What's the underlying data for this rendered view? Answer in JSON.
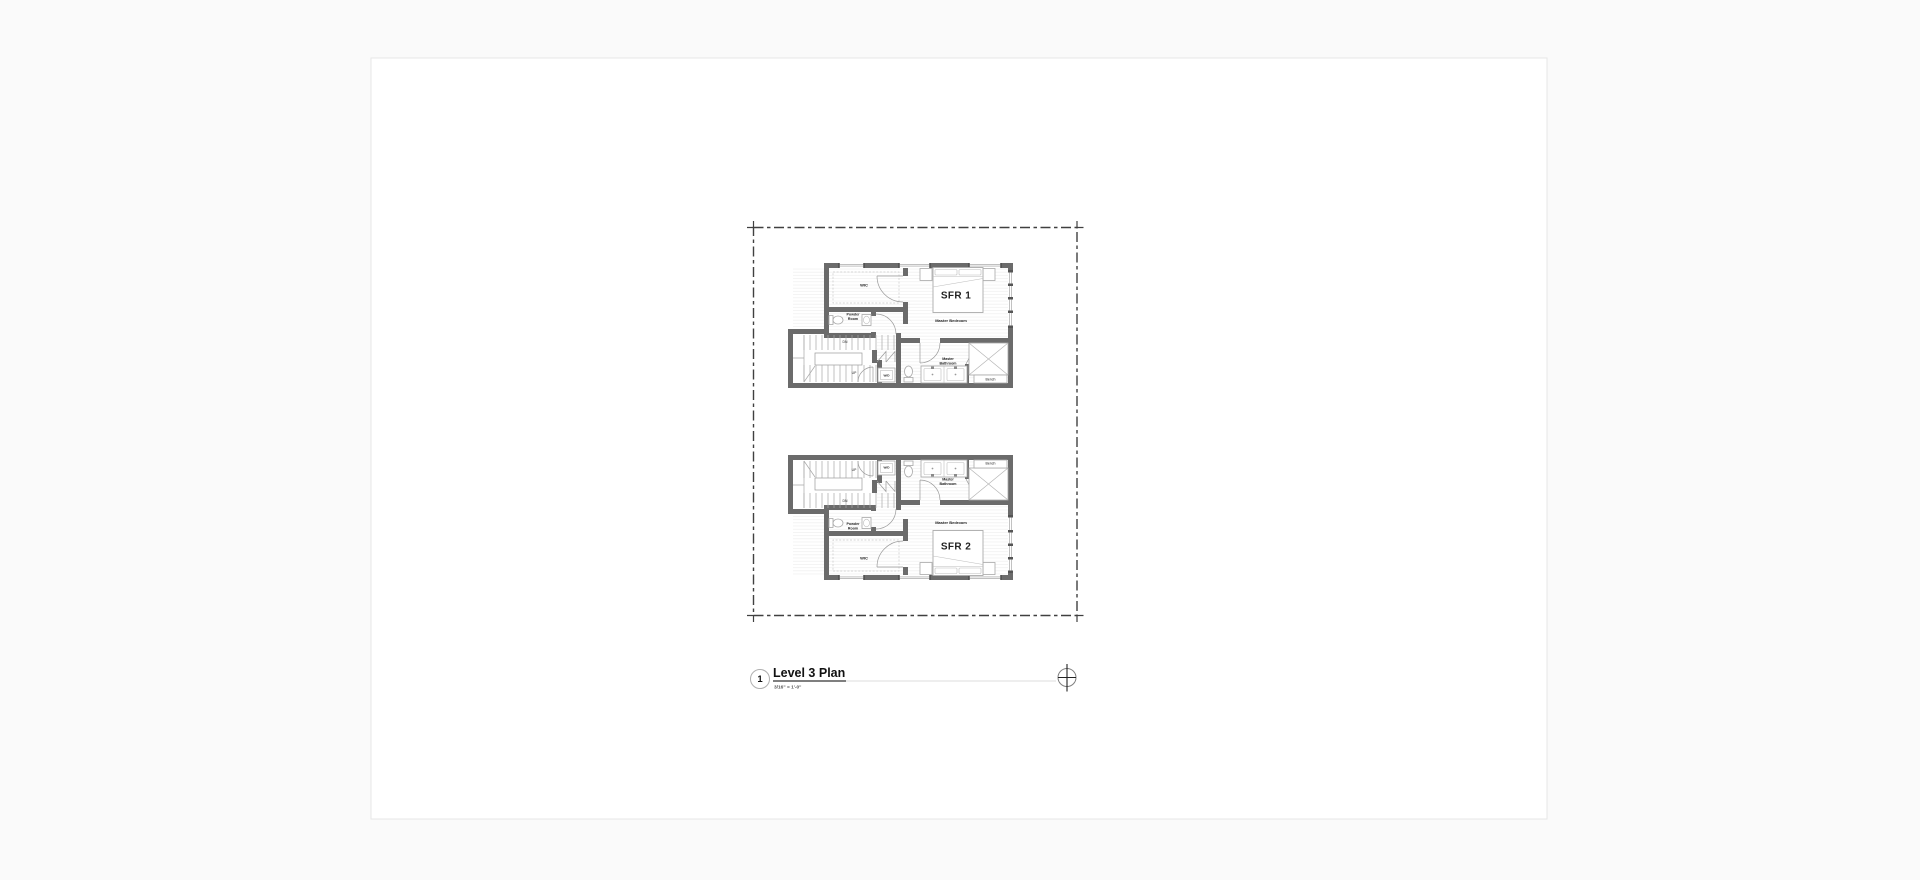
{
  "canvas": {
    "background": "#fafafa"
  },
  "sheet": {
    "background": "#ffffff",
    "border": "#e7e7e7"
  },
  "plan": {
    "colors": {
      "wall": "#6b6b6b",
      "boundary": "#404040",
      "fixture_outline": "#a8a8a8",
      "floor_hatch": "#ececec",
      "window_cap": "#555555"
    },
    "units": [
      {
        "name": "SFR 1",
        "rooms": {
          "wic": "WIC",
          "powder_line1": "Powder",
          "powder_line2": "Room",
          "bedroom": "Master Bedroom",
          "bath_line1": "Master",
          "bath_line2": "Bathroom"
        },
        "fixtures": {
          "wd": "W/D",
          "bench": "Bench"
        },
        "stairs": {
          "dn": "DN",
          "up": "UP"
        }
      },
      {
        "name": "SFR 2",
        "rooms": {
          "wic": "WIC",
          "powder_line1": "Powder",
          "powder_line2": "Room",
          "bedroom": "Master Bedroom",
          "bath_line1": "Master",
          "bath_line2": "Bathroom"
        },
        "fixtures": {
          "wd": "W/D",
          "bench": "Bench"
        },
        "stairs": {
          "dn": "DN",
          "up": "UP"
        }
      }
    ]
  },
  "title_block": {
    "number": "1",
    "title": "Level 3 Plan",
    "scale": "3/16\" = 1'-0\""
  },
  "icons": {
    "north_arrow": "circle-crosshair"
  }
}
